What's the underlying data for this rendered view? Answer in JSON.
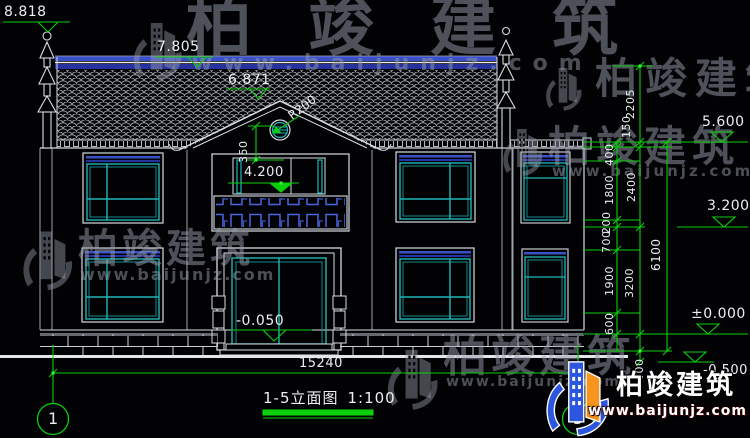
{
  "title": {
    "name": "1-5立面图",
    "scale": "1:100"
  },
  "watermark": {
    "brand": "柏竣建筑",
    "url": "www.baijunjz.com"
  },
  "logo": {
    "brand": "柏竣建筑",
    "url": "www.baijunjz.com"
  },
  "grid": {
    "left_bubble": "1",
    "right_bubble": "5"
  },
  "elevations": {
    "ridge_ornament_top": "8.818",
    "main_ridge": "7.805",
    "gable_ridge": "6.871",
    "balcony_floor": "4.200",
    "entrance_floor": "-0.050",
    "eave": "5.600",
    "second_floor": "3.200",
    "ground_floor": "±0.000",
    "site_ground": "-0.500"
  },
  "dimensions": {
    "overall_width": "15240",
    "overall_height": "6100",
    "gable_rise": "350",
    "round_window_radius": "R200",
    "right_chain_inner": [
      "400",
      "1800",
      "200",
      "700",
      "1900",
      "600"
    ],
    "right_chain_outer": [
      "2205",
      "150",
      "2400",
      "3200",
      "500"
    ]
  }
}
